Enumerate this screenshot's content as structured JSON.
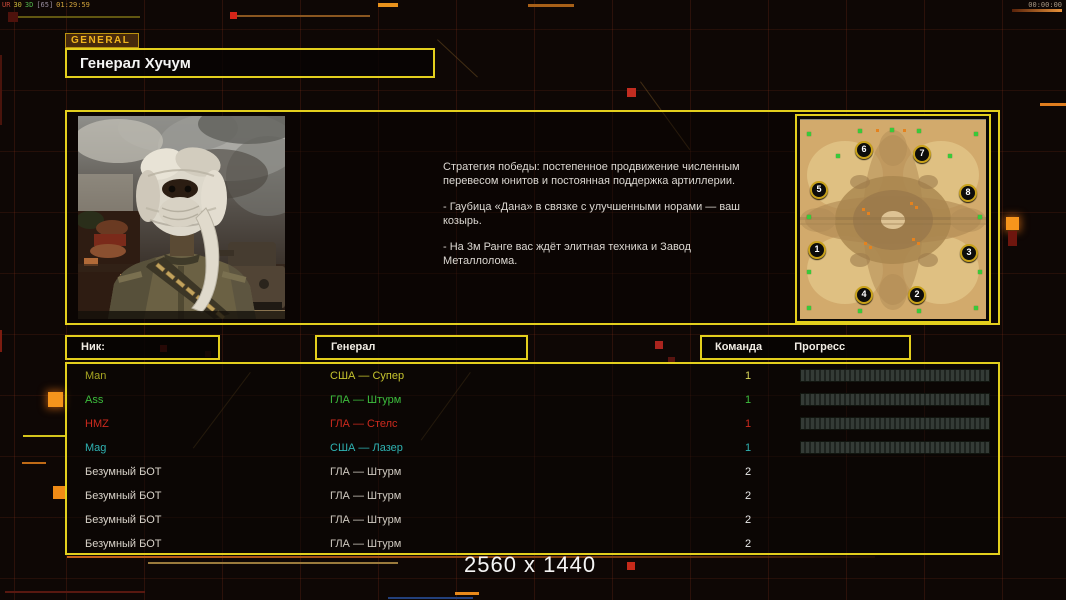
{
  "hud": {
    "top_left_segments": [
      {
        "text": "UR",
        "color": "#c64838"
      },
      {
        "text": "30",
        "color": "#c8b83a"
      },
      {
        "text": "3D",
        "color": "#52b44a"
      },
      {
        "text": "[65]",
        "color": "#9a8fa0"
      },
      {
        "text": "01:29:59",
        "color": "#d2a43c"
      }
    ],
    "top_right_timer": "00:00:00"
  },
  "panel": {
    "tab": "GENERAL",
    "title": "Генерал Хучум"
  },
  "briefing": {
    "paragraphs": [
      "Стратегия победы: постепенное продвижение численным перевесом юнитов и постоянная поддержка артиллерии.",
      "- Гаубица «Дана» в связке с улучшенными норами — ваш козырь.",
      "- На 3м Ранге вас ждёт элитная техника и Завод Металлолома."
    ]
  },
  "map": {
    "start_positions": [
      {
        "num": "1",
        "x": 17,
        "y": 130
      },
      {
        "num": "2",
        "x": 117,
        "y": 175
      },
      {
        "num": "3",
        "x": 169,
        "y": 133
      },
      {
        "num": "4",
        "x": 64,
        "y": 175
      },
      {
        "num": "5",
        "x": 19,
        "y": 70
      },
      {
        "num": "6",
        "x": 64,
        "y": 30
      },
      {
        "num": "7",
        "x": 122,
        "y": 34
      },
      {
        "num": "8",
        "x": 168,
        "y": 73
      }
    ],
    "supply_dots": [
      [
        7,
        12
      ],
      [
        58,
        9
      ],
      [
        90,
        8
      ],
      [
        117,
        9
      ],
      [
        174,
        12
      ],
      [
        36,
        34
      ],
      [
        148,
        34
      ],
      [
        7,
        95
      ],
      [
        178,
        95
      ],
      [
        7,
        150
      ],
      [
        178,
        150
      ],
      [
        7,
        186
      ],
      [
        58,
        189
      ],
      [
        117,
        189
      ],
      [
        174,
        186
      ]
    ],
    "tech_dots": [
      [
        62,
        88
      ],
      [
        67,
        92
      ],
      [
        110,
        82
      ],
      [
        115,
        86
      ],
      [
        64,
        122
      ],
      [
        69,
        126
      ],
      [
        112,
        118
      ],
      [
        117,
        122
      ],
      [
        76,
        9
      ],
      [
        103,
        9
      ]
    ]
  },
  "table": {
    "headers": {
      "nick": "Ник:",
      "general": "Генерал",
      "team": "Команда",
      "progress": "Прогресс"
    },
    "rows": [
      {
        "nick": "Man",
        "general": "США — Супер",
        "team": "1",
        "name_color": "#a8a622",
        "gen_color": "#c6c42e",
        "team_color": "#d8d65a",
        "progress": true
      },
      {
        "nick": "Ass",
        "general": "ГЛА — Штурм",
        "team": "1",
        "name_color": "#3dbd3d",
        "gen_color": "#3dbd3d",
        "team_color": "#3dbd3d",
        "progress": true
      },
      {
        "nick": "HMZ",
        "general": "ГЛА — Стелс",
        "team": "1",
        "name_color": "#cc2a1e",
        "gen_color": "#cc2a1e",
        "team_color": "#cc2a1e",
        "progress": true
      },
      {
        "nick": "Mag",
        "general": "США — Лазер",
        "team": "1",
        "name_color": "#2fb3b3",
        "gen_color": "#2fb3b3",
        "team_color": "#2fb3b3",
        "progress": true
      },
      {
        "nick": "Безумный БОТ",
        "general": "ГЛА — Штурм",
        "team": "2",
        "name_color": "#d8d2c9",
        "gen_color": "#cfc9c0",
        "team_color": "#eaeaea",
        "progress": false
      },
      {
        "nick": "Безумный БОТ",
        "general": "ГЛА — Штурм",
        "team": "2",
        "name_color": "#d8d2c9",
        "gen_color": "#cfc9c0",
        "team_color": "#eaeaea",
        "progress": false
      },
      {
        "nick": "Безумный БОТ",
        "general": "ГЛА — Штурм",
        "team": "2",
        "name_color": "#d8d2c9",
        "gen_color": "#cfc9c0",
        "team_color": "#eaeaea",
        "progress": false
      },
      {
        "nick": "Безумный БОТ",
        "general": "ГЛА — Штурм",
        "team": "2",
        "name_color": "#d8d2c9",
        "gen_color": "#cfc9c0",
        "team_color": "#eaeaea",
        "progress": false
      }
    ]
  },
  "footer": {
    "resolution": "2560 x 1440"
  },
  "colors": {
    "panel_border": "#e3cf1d",
    "accent_orange": "#f6951c",
    "accent_red": "#c62a1a"
  }
}
